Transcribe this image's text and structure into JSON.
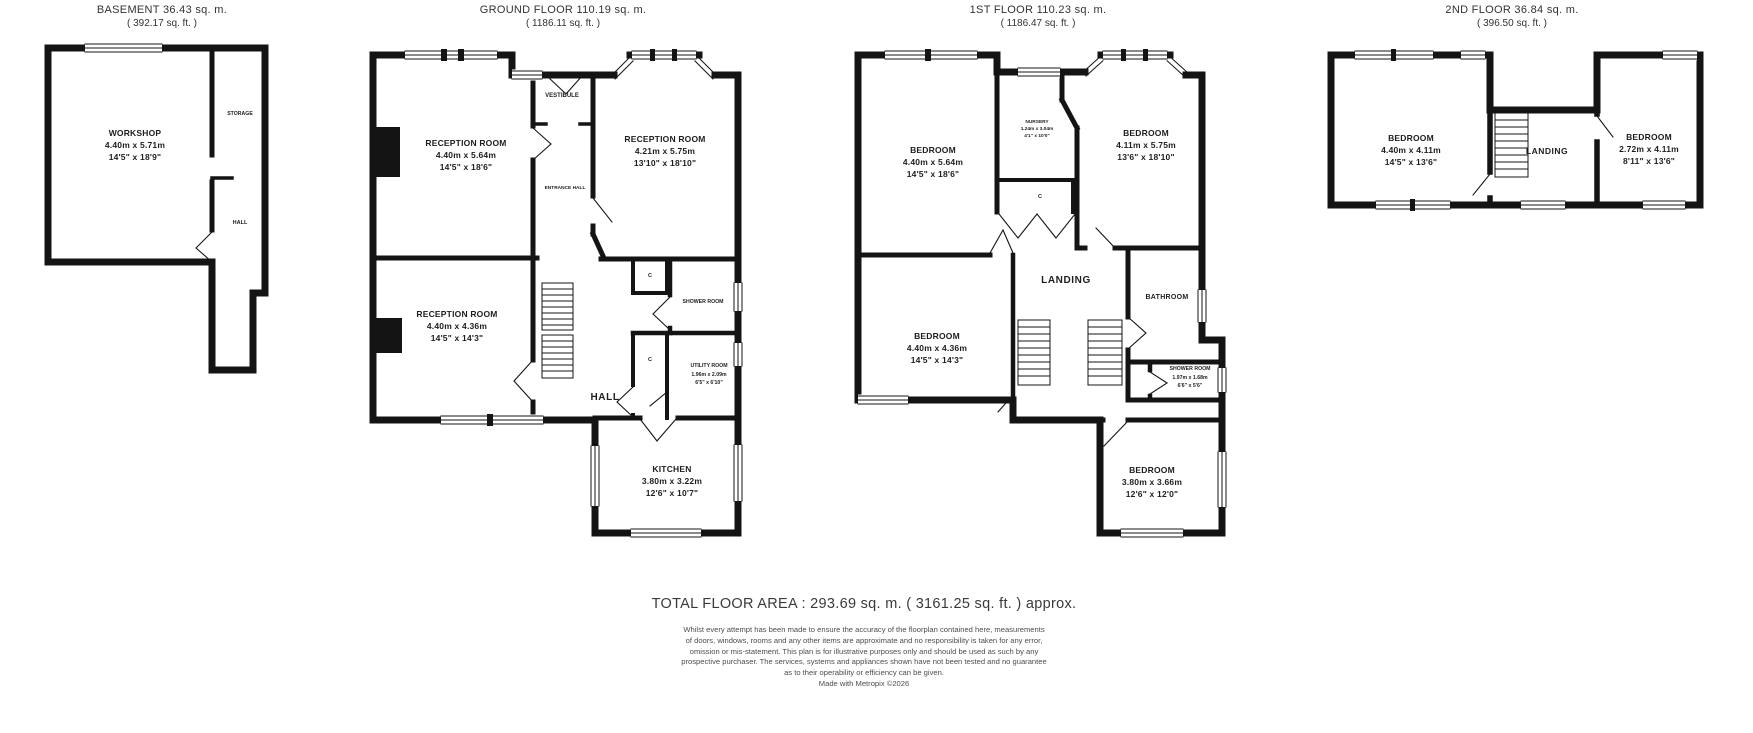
{
  "footer": {
    "total": "TOTAL FLOOR AREA : 293.69 sq. m. ( 3161.25 sq. ft. ) approx.",
    "disclaimer": [
      "Whilst every attempt has been made to ensure the accuracy of the floorplan contained here, measurements",
      "of doors, windows, rooms and any other items are approximate and no responsibility is taken for any error,",
      "omission or mis-statement. This plan is for illustrative purposes only and should be used as such by any",
      "prospective purchaser. The services, systems and appliances shown have not been tested and no guarantee",
      "as to their operability or efficiency can be given."
    ],
    "credit": "Made with Metropix ©2026"
  },
  "colors": {
    "wall": "#141414",
    "text": "#2b2b2b",
    "muted": "#4d4d4d"
  },
  "floors": [
    {
      "title": "BASEMENT 36.43 sq. m.",
      "subtitle": "( 392.17 sq. ft. )",
      "rooms": {
        "workshop": {
          "name": "WORKSHOP",
          "metric": "4.40m x 5.71m",
          "imperial": "14'5\" x 18'9\""
        },
        "storage": {
          "name": "STORAGE"
        },
        "hall": {
          "name": "HALL"
        }
      }
    },
    {
      "title": "GROUND FLOOR 110.19 sq. m.",
      "subtitle": "( 1186.11 sq. ft. )",
      "rooms": {
        "reception1": {
          "name": "RECEPTION ROOM",
          "metric": "4.40m x 5.64m",
          "imperial": "14'5\" x 18'6\""
        },
        "reception2": {
          "name": "RECEPTION ROOM",
          "metric": "4.21m x 5.75m",
          "imperial": "13'10\" x 18'10\""
        },
        "reception3": {
          "name": "RECEPTION ROOM",
          "metric": "4.40m x 4.36m",
          "imperial": "14'5\" x 14'3\""
        },
        "vestibule": {
          "name": "VESTIBULE"
        },
        "entrance_hall": {
          "name": "ENTRANCE HALL"
        },
        "shower": {
          "name": "SHOWER ROOM"
        },
        "utility": {
          "name": "UTILITY ROOM",
          "metric": "1.96m x 2.09m",
          "imperial": "6'5\" x 6'10\""
        },
        "hall": {
          "name": "HALL"
        },
        "kitchen": {
          "name": "KITCHEN",
          "metric": "3.80m x 3.22m",
          "imperial": "12'6\" x 10'7\""
        },
        "cupboard": {
          "name": "C"
        }
      }
    },
    {
      "title": "1ST FLOOR 110.23 sq. m.",
      "subtitle": "( 1186.47 sq. ft. )",
      "rooms": {
        "bedroom1": {
          "name": "BEDROOM",
          "metric": "4.40m x 5.64m",
          "imperial": "14'5\" x 18'6\""
        },
        "nursery": {
          "name": "NURSERY",
          "metric": "1.24m x 3.04m",
          "imperial": "4'1\" x 10'0\""
        },
        "bedroom2": {
          "name": "BEDROOM",
          "metric": "4.11m x 5.75m",
          "imperial": "13'6\" x 18'10\""
        },
        "bedroom3": {
          "name": "BEDROOM",
          "metric": "4.40m x 4.36m",
          "imperial": "14'5\" x 14'3\""
        },
        "landing": {
          "name": "LANDING"
        },
        "bathroom": {
          "name": "BATHROOM"
        },
        "shower": {
          "name": "SHOWER ROOM",
          "metric": "1.97m x 1.68m",
          "imperial": "6'6\" x 5'6\""
        },
        "bedroom4": {
          "name": "BEDROOM",
          "metric": "3.80m x 3.66m",
          "imperial": "12'6\" x 12'0\""
        },
        "cupboard": {
          "name": "C"
        }
      }
    },
    {
      "title": "2ND FLOOR 36.84 sq. m.",
      "subtitle": "( 396.50 sq. ft. )",
      "rooms": {
        "bedroom1": {
          "name": "BEDROOM",
          "metric": "4.40m x 4.11m",
          "imperial": "14'5\" x 13'6\""
        },
        "landing": {
          "name": "LANDING"
        },
        "bedroom2": {
          "name": "BEDROOM",
          "metric": "2.72m x 4.11m",
          "imperial": "8'11\" x 13'6\""
        }
      }
    }
  ]
}
